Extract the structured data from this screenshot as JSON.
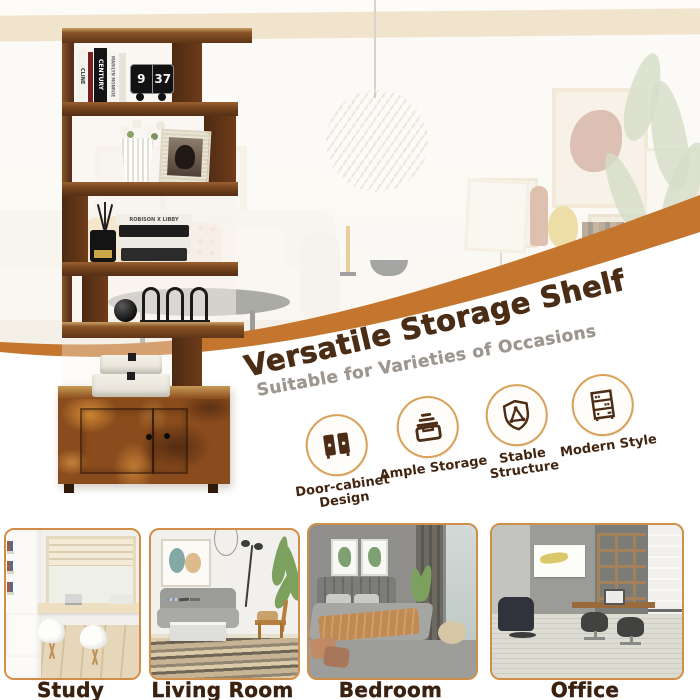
{
  "banner": {
    "title": "Versatile Storage Shelf",
    "subtitle": "Suitable for Varieties of Occasions"
  },
  "features": [
    {
      "icon": "door-cabinet-icon",
      "line1": "Door-cabinet",
      "line2": "Design"
    },
    {
      "icon": "ample-storage-icon",
      "line1": "Ample Storage",
      "line2": ""
    },
    {
      "icon": "stable-structure-icon",
      "line1": "Stable",
      "line2": "Structure"
    },
    {
      "icon": "modern-style-icon",
      "line1": "Modern Style",
      "line2": ""
    }
  ],
  "rooms": [
    {
      "label": "Study Room"
    },
    {
      "label": "Living Room"
    },
    {
      "label": "Bedroom"
    },
    {
      "label": "Office"
    }
  ],
  "shelf": {
    "clock": {
      "hour": "9",
      "minute": "37"
    },
    "book_spines": [
      "CLINE",
      "CENTURY",
      "MARILYN MONROE"
    ],
    "stacked_book_text": "ROBISON X LIBBY"
  },
  "colors": {
    "swoosh_orange": "#c4762e",
    "title_brown": "#4b2d16",
    "subtitle_gray": "#9c968f",
    "label_brown": "#3a2110",
    "circle_border": "#d9a157",
    "card_border": "#cf8f4a"
  }
}
